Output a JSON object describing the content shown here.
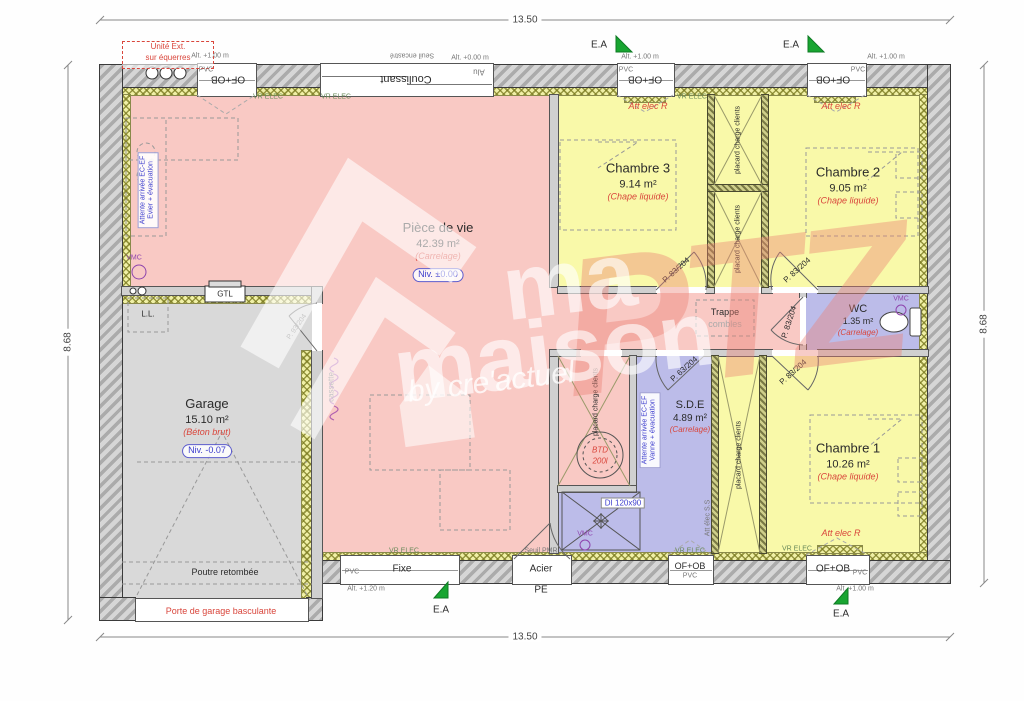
{
  "dimensions": {
    "top": "13.50",
    "bottom": "13.50",
    "left": "8.68",
    "right": "8.68"
  },
  "rooms": {
    "living": {
      "name": "Pièce de vie",
      "area": "42.39 m²",
      "floor": "(Carrelage)",
      "level": "Niv. ±0.00"
    },
    "garage": {
      "name": "Garage",
      "area": "15.10 m²",
      "floor": "(Béton brut)",
      "level": "Niv. -0.07"
    },
    "ch3": {
      "name": "Chambre 3",
      "area": "9.14 m²",
      "floor": "(Chape liquide)"
    },
    "ch2": {
      "name": "Chambre 2",
      "area": "9.05 m²",
      "floor": "(Chape liquide)"
    },
    "ch1": {
      "name": "Chambre 1",
      "area": "10.26 m²",
      "floor": "(Chape liquide)"
    },
    "wc": {
      "name": "WC",
      "area": "1.35 m²",
      "floor": "(Carrelage)"
    },
    "sde": {
      "name": "S.D.E",
      "area": "4.89 m²",
      "floor": "(Carrelage)"
    }
  },
  "openings": {
    "of_ob": "OF+OB",
    "coulissant": "Coulissant",
    "fixe": "Fixe",
    "acier": "Acier",
    "pe": "PE",
    "pvc": "PVC",
    "alu": "Alu",
    "seuil_encastre": "Seuil encastré",
    "seuil_pmr": "Seuil PMR",
    "alt_100": "Alt. +1.00 m",
    "alt_000": "Alt. +0.00 m",
    "alt_120": "Alt. +1.20 m",
    "porte_garage": "Porte de garage basculante",
    "door_83": "P. 83/204",
    "door_63": "P. 63/204",
    "door_93": "P. 93/204",
    "ea": "E.A",
    "vr_elec": "VR ELEC"
  },
  "annotations": {
    "unite_ext_1": "Unité Ext.",
    "unite_ext_2": "sur équerres",
    "att_elec_r": "Att elec R",
    "att_elec_ss": "Att élec S.S",
    "vmc": "VMC",
    "gtl": "GTL",
    "ll": "L.L.",
    "cassette": "cassette",
    "trappe_1": "Trappe",
    "trappe_2": "combles",
    "poutre": "Poutre retombée",
    "placard": "placard charge clients",
    "btd_1": "BTD",
    "btd_2": "200l",
    "di": "DI 120x90",
    "attente_evier_1": "Attente arrivée EC-EF",
    "attente_evier_2": "Evier + évacuation",
    "attente_vanne_1": "Attente arrivée EC-EF",
    "attente_vanne_2": "Vanne + évacuation"
  },
  "watermark": {
    "ma": "ma",
    "maison": "maison",
    "ptz": "PTZ",
    "by": "by cre'actuel"
  },
  "colors": {
    "living": "#f9c9c4",
    "bedroom": "#f9f9a9",
    "wet": "#bcbce9",
    "garage": "#d9d9d9",
    "accent_red": "#d9463c",
    "accent_blue": "#3c3ccd",
    "accent_green": "#18a531"
  }
}
